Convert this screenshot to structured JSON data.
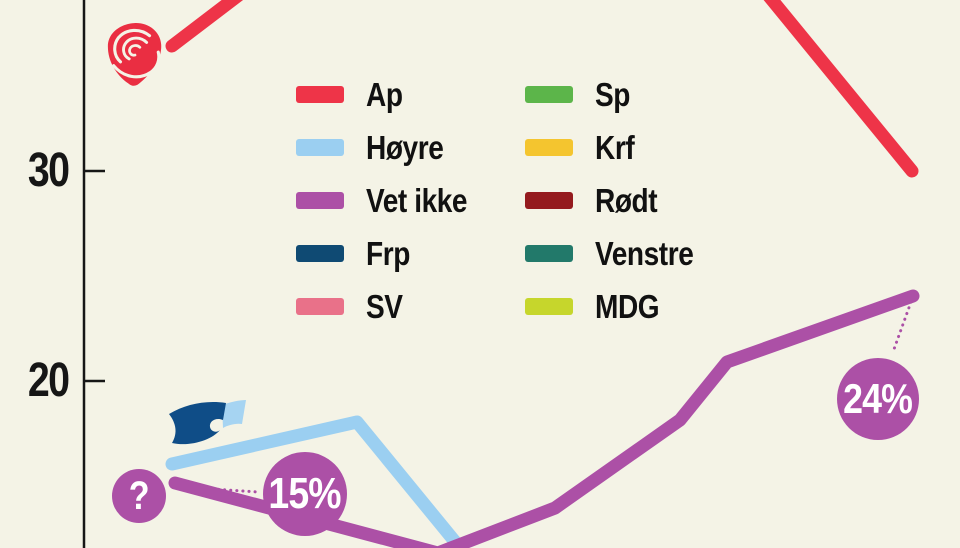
{
  "background_color": "#f4f3e6",
  "axis": {
    "color": "#161616",
    "ticks": [
      {
        "label": "30"
      },
      {
        "label": "20"
      }
    ]
  },
  "legend": {
    "columns": [
      [
        {
          "label": "Ap",
          "color": "#ee3448"
        },
        {
          "label": "Høyre",
          "color": "#9bcff1"
        },
        {
          "label": "Vet ikke",
          "color": "#ac50a6"
        },
        {
          "label": "Frp",
          "color": "#0f4a73"
        },
        {
          "label": "SV",
          "color": "#e97189"
        }
      ],
      [
        {
          "label": "Sp",
          "color": "#5cb54a"
        },
        {
          "label": "Krf",
          "color": "#f4c52f"
        },
        {
          "label": "Rødt",
          "color": "#941a1e"
        },
        {
          "label": "Venstre",
          "color": "#22796a"
        },
        {
          "label": "MDG",
          "color": "#c6d62c"
        }
      ]
    ]
  },
  "annotations": {
    "bubble_color": "#ac50a6",
    "question": "?",
    "start_value": "15%",
    "end_value": "24%"
  },
  "icons": {
    "ap_logo": "ap-rose-logo",
    "hoyre_logo": "hoyre-flag-logo"
  },
  "chart_data": {
    "type": "line",
    "title": "",
    "xlabel": "",
    "ylabel": "",
    "y_ticks_visible": [
      30,
      20
    ],
    "grid": false,
    "legend_position": "top-center-two-columns",
    "note": "cropped poll-trend infographic; only Ap, Høyre and Vet ikke lines are inside the visible crop",
    "series": [
      {
        "name": "Ap",
        "color": "#ee3448",
        "visible_values": {
          "first": 36,
          "last": 30
        },
        "points_px": [
          [
            172,
            46
          ],
          [
            357,
            -95
          ],
          [
            727,
            -55
          ],
          [
            912,
            171
          ]
        ]
      },
      {
        "name": "Høyre",
        "color": "#9bcff1",
        "visible_values": {
          "first": 16,
          "peak": 18
        },
        "points_px": [
          [
            172,
            464
          ],
          [
            357,
            422
          ],
          [
            470,
            560
          ]
        ]
      },
      {
        "name": "Vet ikke",
        "color": "#ac50a6",
        "visible_values": {
          "first": 15,
          "bend": 21,
          "last": 24
        },
        "points_px": [
          [
            175,
            483
          ],
          [
            438,
            553
          ],
          [
            555,
            508
          ],
          [
            680,
            420
          ],
          [
            727,
            362
          ],
          [
            913,
            296
          ]
        ]
      }
    ],
    "connectors_px": [
      {
        "name": "connector-15pct",
        "from": [
          182,
          487
        ],
        "to": [
          258,
          492
        ]
      },
      {
        "name": "connector-24pct",
        "from": [
          911,
          302
        ],
        "to": [
          893,
          352
        ]
      }
    ]
  }
}
